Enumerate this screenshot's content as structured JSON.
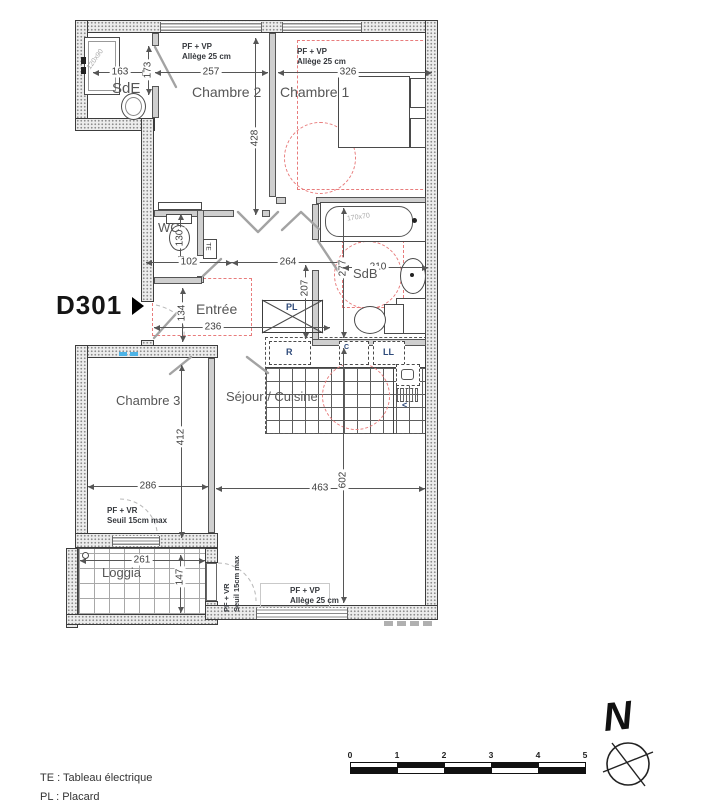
{
  "unit": {
    "label": "D301"
  },
  "rooms": {
    "sde": "SdE",
    "ch2": "Chambre 2",
    "ch1": "Chambre 1",
    "wc": "WC",
    "entree": "Entrée",
    "sdb": "SdB",
    "sejour": "Séjour / Cuisine",
    "ch3": "Chambre 3",
    "loggia": "Loggia"
  },
  "dims": {
    "d163": "163",
    "d173": "173",
    "d257": "257",
    "d326": "326",
    "d428": "428",
    "d130": "130",
    "d102": "102",
    "d264": "264",
    "d207": "207",
    "d277": "277",
    "d210": "210",
    "d134": "134",
    "d236": "236",
    "d412": "412",
    "d286": "286",
    "d463": "463",
    "d602": "602",
    "d261": "261",
    "d147": "147"
  },
  "fixtures": {
    "shower": "120x90",
    "bathtub": "170x70"
  },
  "equipment": {
    "te": "TE",
    "pl": "PL",
    "fridge": "R",
    "hob": "C",
    "washer": "LL",
    "vent": "<"
  },
  "annotations": {
    "win_ch2_l1": "PF + VP",
    "win_ch2_l2": "Allège 25 cm",
    "win_ch1_l1": "PF + VP",
    "win_ch1_l2": "Allège 25 cm",
    "win_ch3_l1": "PF + VR",
    "win_ch3_l2": "Seuil 15cm max",
    "door_loggia_l1": "PF + VR",
    "door_loggia_l2": "Seuil 15cm max",
    "win_sejour_l1": "PF + VP",
    "win_sejour_l2": "Allège 25 cm"
  },
  "legend": {
    "line1": "TE : Tableau électrique",
    "line2": "PL : Placard"
  },
  "scalebar": {
    "t0": "0",
    "t1": "1",
    "t2": "2",
    "t3": "3",
    "t4": "4",
    "t5": "5"
  },
  "compass": {
    "label": "N"
  },
  "colors": {
    "red_dashed": "#e87c7c",
    "wall_line": "#3c3c3c"
  }
}
